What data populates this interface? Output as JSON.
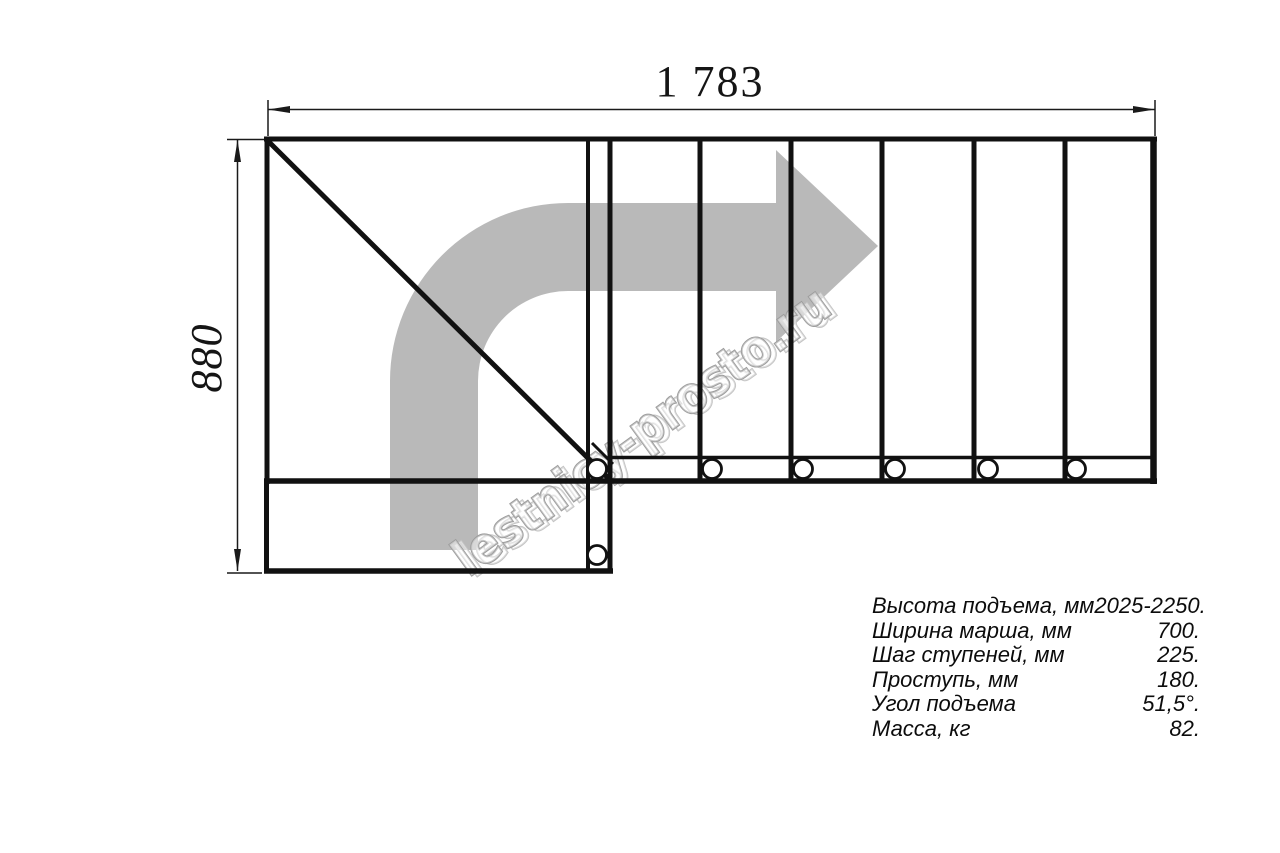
{
  "dims": {
    "top_value": "1 783",
    "left_value": "880"
  },
  "watermark": {
    "text": "lestnicy-prosto.ru"
  },
  "colors": {
    "line": "#111111",
    "thin_line": "#1a1a1a",
    "arrow_gray": "#b9b9b9",
    "watermark_stroke": "#9c9c9c",
    "watermark_shadow": "#c4c4c4",
    "circle_fill": "#ffffff"
  },
  "specs": {
    "rows": [
      {
        "label": "Высота подъема, мм",
        "value": "2025-2250."
      },
      {
        "label": "Ширина марша, мм",
        "value": "700."
      },
      {
        "label": "Шаг ступеней, мм",
        "value": "225."
      },
      {
        "label": "Проступь, мм",
        "value": "180."
      },
      {
        "label": "Угол подъема",
        "value": "51,5°."
      },
      {
        "label": "Масса, кг",
        "value": "82."
      }
    ]
  }
}
